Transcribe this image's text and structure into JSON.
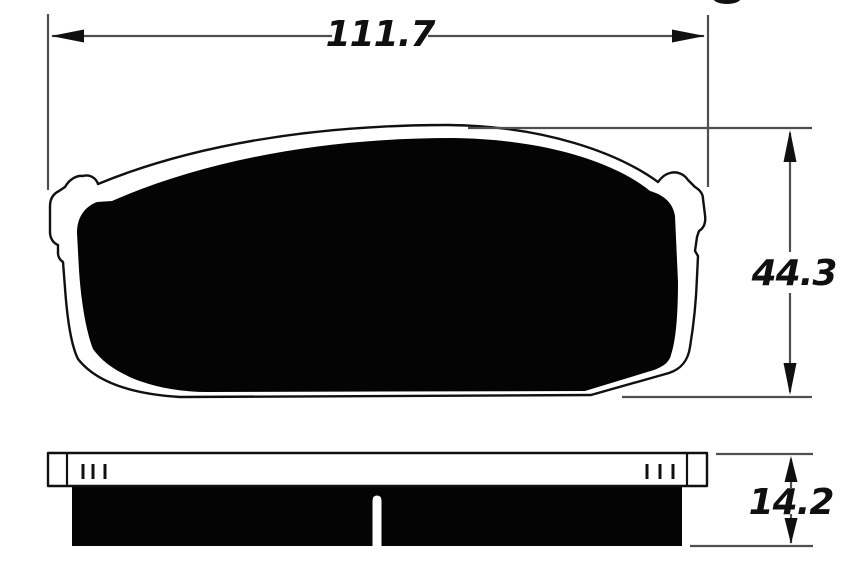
{
  "colors": {
    "paper": "#ffffff",
    "ink": "#101010",
    "fill_black": "#040404",
    "dim_line": "#4f4f4f"
  },
  "dimensions": {
    "width": "111.7",
    "height": "44.3",
    "thickness": "14.2"
  }
}
